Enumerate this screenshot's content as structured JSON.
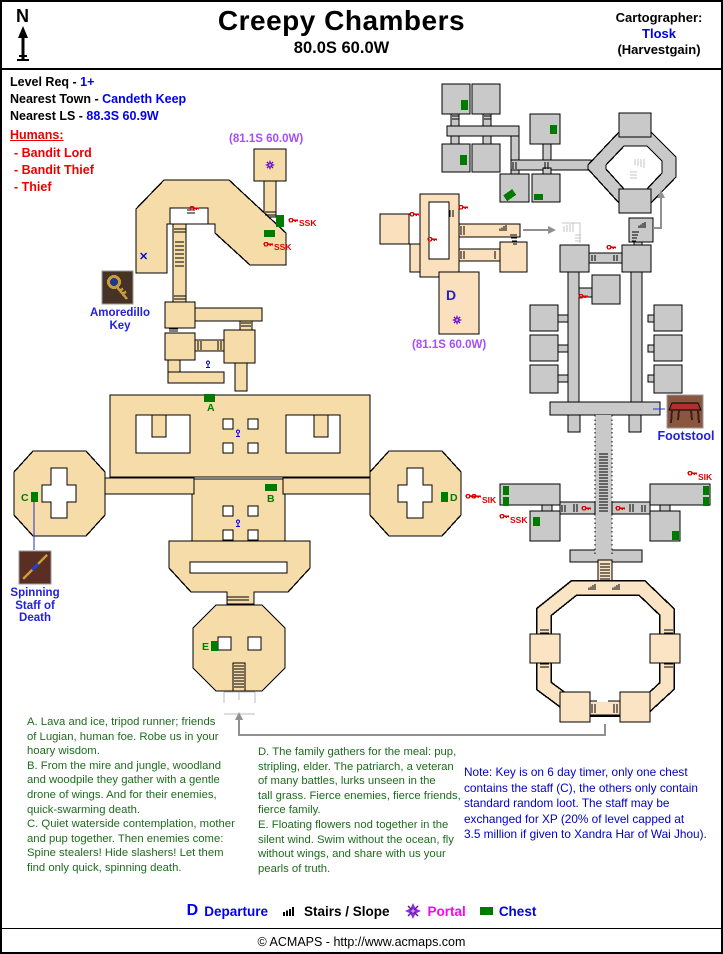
{
  "header": {
    "compass": "N",
    "title": "Creepy Chambers",
    "subtitle": "80.0S 60.0W",
    "cartographer_label": "Cartographer:",
    "cartographer_name": "Tlosk",
    "cartographer_server": "(Harvestgain)"
  },
  "info": {
    "level_req_label": "Level Req - ",
    "level_req_value": "1+",
    "town_label": "Nearest Town - ",
    "town_value": "Candeth Keep",
    "ls_label": "Nearest LS - ",
    "ls_value": "88.3S 60.9W"
  },
  "humans": {
    "heading": "Humans:",
    "items_text": "- Bandit Lord\n- Bandit Thief\n- Thief"
  },
  "map": {
    "portal_coord": "(81.1S 60.0W)",
    "x_marker": "✕",
    "departure_letter": "D",
    "chest_a": "A",
    "chest_b": "B",
    "chest_c": "C",
    "chest_d": "D",
    "chest_e": "E",
    "tag_ssk": "SSK",
    "tag_sik": "SIK"
  },
  "items": {
    "amoredillo": "Amoredillo\nKey",
    "staff": "Spinning\nStaff of\nDeath",
    "footstool": "Footstool"
  },
  "notes": {
    "left": "A. Lava and ice, tripod runner; friends\nof Lugian, human foe. Robe us in your\nhoary wisdom.\nB. From the mire and jungle, woodland\nand woodpile they gather with a gentle\ndrone of wings. And for their enemies,\nquick-swarming death.\nC. Quiet waterside contemplation, mother\nand pup together. Then enemies come:\nSpine stealers! Hide slashers! Let them\nfind only quick, spinning death.",
    "middle": "D. The family gathers for the meal: pup,\nstripling, elder. The patriarch, a veteran\nof many battles, lurks unseen in the\ntall grass. Fierce enemies, fierce friends,\nfierce family.\nE. Floating flowers nod together in the\nsilent wind. Swim without the ocean, fly\nwithout wings, and share with us your\npearls of truth.",
    "right": "Note: Key is on 6 day timer, only one chest\ncontains the staff (C), the others only contain\nstandard random loot. The staff may be\nexchanged for XP (20% of level capped at\n3.5 million if given to Xandra Har of Wai Jhou)."
  },
  "legend": {
    "departure_symbol": "D",
    "departure_label": "Departure",
    "stairs_label": "Stairs / Slope",
    "portal_label": "Portal",
    "chest_label": "Chest"
  },
  "footer": {
    "copyright": "© ACMAPS - http://www.acmaps.com"
  },
  "colors": {
    "tan_main": "#F6DCA9",
    "tan_light": "#FAE4C4",
    "gray_room": "#C9C9C9",
    "chest_green": "#007A00",
    "label_green": "#008000",
    "note_blue": "#0000CC",
    "text_green": "#1E6B1E",
    "red": "#EE0000",
    "purple_coord": "#A64DFF",
    "portal_magenta": "#FF00FF",
    "blue": "#0000EE"
  }
}
